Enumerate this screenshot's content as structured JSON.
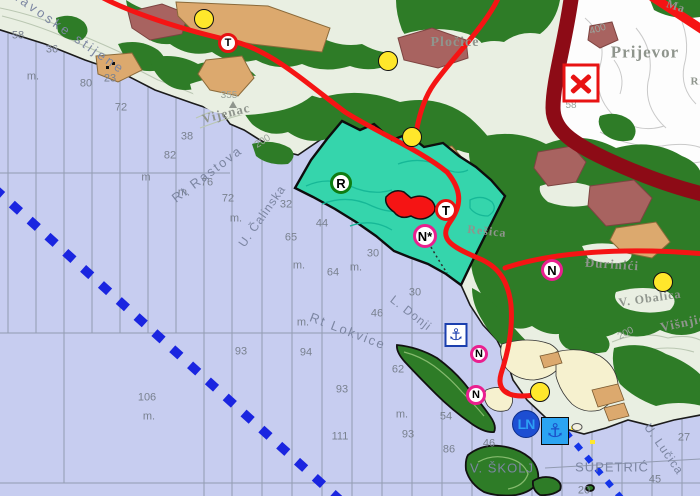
{
  "map": {
    "colors": {
      "sea": "#c7cdf0",
      "land": "#e9efe2",
      "white_topo": "#fdfdfd",
      "forest": "#2e7c27",
      "zone_teal": "#35d5ac",
      "zone_contour": "#16b897",
      "road_red": "#f51414",
      "road_major_maroon": "#8d0b16",
      "field_tan": "#dca96e",
      "settlement_rose": "#a86360",
      "village_cream": "#f6f1cf",
      "boundary_blue": "#1a25e0",
      "grid_gray": "#8d96ab",
      "sounding_gray": "#79818f",
      "sea_label_gray": "#7c86a2",
      "place_label_gray": "#8f958d",
      "contour_label_gray": "#9aa39b",
      "marker_yellow": "#ffe72b",
      "ring_red": "#e81313",
      "ring_green": "#0e7d12",
      "ring_magenta": "#ea1f8f",
      "anchor_blue": "#1b3fae",
      "anchor_fill_blue": "#2ba4f2",
      "anchor_glyph_blue": "#1b50c9",
      "ln_blue": "#1d4ed2",
      "ln_text": "#2d9ff5"
    },
    "soundings": [
      {
        "v": "58",
        "x": 18,
        "y": 36
      },
      {
        "v": "36",
        "x": 52,
        "y": 50
      },
      {
        "v": "m.",
        "x": 33,
        "y": 77
      },
      {
        "v": "80",
        "x": 86,
        "y": 84
      },
      {
        "v": "23",
        "x": 110,
        "y": 79
      },
      {
        "v": "72",
        "x": 121,
        "y": 108
      },
      {
        "v": "38",
        "x": 187,
        "y": 137
      },
      {
        "v": "82",
        "x": 170,
        "y": 156
      },
      {
        "v": "m",
        "x": 146,
        "y": 178
      },
      {
        "v": "76",
        "x": 207,
        "y": 183
      },
      {
        "v": "m.",
        "x": 184,
        "y": 193
      },
      {
        "v": "72",
        "x": 228,
        "y": 199
      },
      {
        "v": "m.",
        "x": 236,
        "y": 219
      },
      {
        "v": "32",
        "x": 286,
        "y": 205
      },
      {
        "v": "44",
        "x": 322,
        "y": 224
      },
      {
        "v": "65",
        "x": 291,
        "y": 238
      },
      {
        "v": "30",
        "x": 373,
        "y": 254
      },
      {
        "v": "m.",
        "x": 299,
        "y": 266
      },
      {
        "v": "64",
        "x": 333,
        "y": 273
      },
      {
        "v": "m.",
        "x": 356,
        "y": 268
      },
      {
        "v": "30",
        "x": 415,
        "y": 293
      },
      {
        "v": "46",
        "x": 377,
        "y": 314
      },
      {
        "v": "m.",
        "x": 303,
        "y": 323
      },
      {
        "v": "93",
        "x": 241,
        "y": 352
      },
      {
        "v": "94",
        "x": 306,
        "y": 353
      },
      {
        "v": "62",
        "x": 398,
        "y": 370
      },
      {
        "v": "93",
        "x": 342,
        "y": 390
      },
      {
        "v": "m.",
        "x": 402,
        "y": 415
      },
      {
        "v": "111",
        "x": 340,
        "y": 437
      },
      {
        "v": "93",
        "x": 408,
        "y": 435
      },
      {
        "v": "54",
        "x": 446,
        "y": 417
      },
      {
        "v": "86",
        "x": 449,
        "y": 450
      },
      {
        "v": "106",
        "x": 147,
        "y": 398
      },
      {
        "v": "m.",
        "x": 149,
        "y": 417
      },
      {
        "v": "46",
        "x": 489,
        "y": 444
      },
      {
        "v": "45",
        "x": 655,
        "y": 480
      },
      {
        "v": "27",
        "x": 684,
        "y": 438
      },
      {
        "v": "20",
        "x": 584,
        "y": 491
      }
    ],
    "sea_labels": [
      {
        "t": "Konavoske stijene",
        "x": 60,
        "y": 26,
        "rot": 35,
        "size": 13,
        "sp": 3
      },
      {
        "t": "Rt Rastova",
        "x": 207,
        "y": 174,
        "rot": -37,
        "size": 13,
        "sp": 2
      },
      {
        "t": "U. Čalinska",
        "x": 262,
        "y": 216,
        "rot": -55,
        "size": 12,
        "sp": 1
      },
      {
        "t": "Rt Lokvice",
        "x": 348,
        "y": 331,
        "rot": 21,
        "size": 13,
        "sp": 2
      },
      {
        "t": "L. Donji",
        "x": 411,
        "y": 313,
        "rot": 38,
        "size": 12,
        "sp": 1
      },
      {
        "t": "U. Lučica",
        "x": 664,
        "y": 449,
        "rot": 55,
        "size": 12,
        "sp": 1
      },
      {
        "t": "V. ŠKOLJ",
        "x": 502,
        "y": 468,
        "rot": 0,
        "size": 13,
        "sp": 1
      },
      {
        "t": "SUPETRIĆ",
        "x": 612,
        "y": 467,
        "rot": 0,
        "size": 13,
        "sp": 1
      }
    ],
    "place_labels": [
      {
        "t": "Prijevor",
        "x": 645,
        "y": 52,
        "rot": 0,
        "size": 17
      },
      {
        "t": "Pločice",
        "x": 455,
        "y": 43,
        "rot": 0,
        "size": 14
      },
      {
        "t": "Vijenac",
        "x": 226,
        "y": 113,
        "rot": -14,
        "size": 13
      },
      {
        "t": "Višnjići",
        "x": 685,
        "y": 322,
        "rot": -12,
        "size": 13
      },
      {
        "t": "V. Obalica",
        "x": 650,
        "y": 298,
        "rot": -8,
        "size": 12
      },
      {
        "t": "Đurinići",
        "x": 612,
        "y": 264,
        "rot": 4,
        "size": 13
      },
      {
        "t": "Rešica",
        "x": 487,
        "y": 231,
        "rot": 6,
        "size": 12
      },
      {
        "t": "Ma",
        "x": 676,
        "y": 6,
        "rot": 18,
        "size": 12
      },
      {
        "t": "Ri",
        "x": 697,
        "y": 82,
        "rot": 0,
        "size": 11
      }
    ],
    "contour_labels": [
      {
        "t": "400",
        "x": 598,
        "y": 30,
        "rot": -18
      },
      {
        "t": "200",
        "x": 263,
        "y": 142,
        "rot": -32
      },
      {
        "t": "200",
        "x": 626,
        "y": 334,
        "rot": -28
      },
      {
        "t": "58",
        "x": 571,
        "y": 106,
        "rot": 0
      },
      {
        "t": "355",
        "x": 229,
        "y": 96,
        "rot": 0
      }
    ],
    "symbols": {
      "yellow_dots": [
        {
          "x": 204,
          "y": 19
        },
        {
          "x": 388,
          "y": 61
        },
        {
          "x": 412,
          "y": 137
        },
        {
          "x": 663,
          "y": 282
        },
        {
          "x": 540,
          "y": 392
        }
      ],
      "letter_markers": [
        {
          "letter": "T",
          "ring": "ring_red",
          "x": 228,
          "y": 43,
          "r": 10
        },
        {
          "letter": "R",
          "ring": "ring_green",
          "x": 341,
          "y": 183,
          "r": 11
        },
        {
          "letter": "T",
          "ring": "ring_red",
          "x": 446,
          "y": 210,
          "r": 11
        },
        {
          "letter": "N*",
          "ring": "ring_magenta",
          "x": 425,
          "y": 236,
          "r": 12
        },
        {
          "letter": "N",
          "ring": "ring_magenta",
          "x": 552,
          "y": 270,
          "r": 11
        },
        {
          "letter": "N",
          "ring": "ring_magenta",
          "x": 479,
          "y": 354,
          "r": 9
        },
        {
          "letter": "N",
          "ring": "ring_magenta",
          "x": 476,
          "y": 395,
          "r": 10
        }
      ],
      "anchor_markers": [
        {
          "style": "outline",
          "x": 456,
          "y": 335,
          "w": 23,
          "h": 24
        },
        {
          "style": "solid",
          "x": 555,
          "y": 431,
          "w": 28,
          "h": 28
        }
      ],
      "ln_marker": {
        "label": "LN",
        "x": 526,
        "y": 424,
        "r": 14
      },
      "x_marker": {
        "x": 581,
        "y": 83,
        "w": 37,
        "h": 39
      }
    }
  }
}
